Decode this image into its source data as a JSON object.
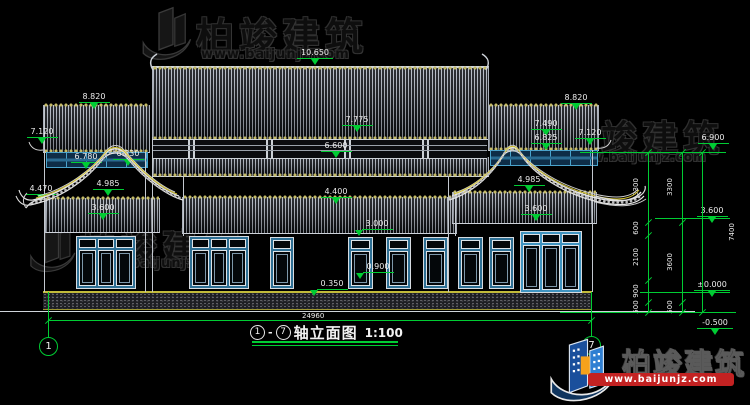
{
  "watermark": {
    "brand": "柏竣建筑",
    "url": "www.baijunjz.com"
  },
  "title_block": {
    "axis_start": "1",
    "dash": "-",
    "axis_end": "7",
    "name": "轴立面图",
    "scale": "1:100"
  },
  "bottom_dim": {
    "value": "24960",
    "x1": 48,
    "x2": 591,
    "y": 320,
    "tx": 316,
    "ty": 312
  },
  "axes": [
    {
      "label": "1",
      "cx": 48,
      "cy": 346,
      "stem_y1": 292
    },
    {
      "label": "7",
      "cx": 591,
      "cy": 345,
      "stem_y1": 292
    }
  ],
  "elevations": [
    {
      "v": "10.650",
      "x": 315,
      "y": 49
    },
    {
      "v": "8.820",
      "x": 94,
      "y": 93
    },
    {
      "v": "8.820",
      "x": 576,
      "y": 94
    },
    {
      "v": "7.775",
      "x": 357,
      "y": 116
    },
    {
      "v": "7.490",
      "x": 546,
      "y": 120
    },
    {
      "v": "7.120",
      "x": 42,
      "y": 128
    },
    {
      "v": "7.120",
      "x": 590,
      "y": 129
    },
    {
      "v": "6.825",
      "x": 546,
      "y": 134
    },
    {
      "v": "6.900",
      "x": 713,
      "y": 134
    },
    {
      "v": "6.780",
      "x": 86,
      "y": 153
    },
    {
      "v": "6.830",
      "x": 128,
      "y": 150
    },
    {
      "v": "6.600",
      "x": 336,
      "y": 142
    },
    {
      "v": "4.985",
      "x": 108,
      "y": 180
    },
    {
      "v": "4.985",
      "x": 529,
      "y": 176
    },
    {
      "v": "4.470",
      "x": 41,
      "y": 185
    },
    {
      "v": "4.400",
      "x": 336,
      "y": 188
    },
    {
      "v": "3.600",
      "x": 103,
      "y": 204
    },
    {
      "v": "3.600",
      "x": 536,
      "y": 205
    },
    {
      "v": "3.600",
      "x": 712,
      "y": 207
    },
    {
      "v": "3.000",
      "x": 377,
      "y": 220,
      "tri": "l"
    },
    {
      "v": "0.900",
      "x": 378,
      "y": 263,
      "tri": "l"
    },
    {
      "v": "0.350",
      "x": 332,
      "y": 280,
      "tri": "l"
    },
    {
      "v": "±0.000",
      "x": 712,
      "y": 281
    },
    {
      "v": "-0.500",
      "x": 715,
      "y": 319
    }
  ],
  "vchains": [
    {
      "x": 648,
      "y1": 152,
      "y2": 312,
      "ticks": [
        152,
        222,
        235,
        280,
        302,
        312
      ],
      "labels": [
        {
          "t": "3300",
          "y": 187
        },
        {
          "t": "600",
          "y": 228
        },
        {
          "t": "2100",
          "y": 257
        },
        {
          "t": "900",
          "y": 291
        },
        {
          "t": "500",
          "y": 307
        }
      ]
    },
    {
      "x": 682,
      "y1": 152,
      "y2": 312,
      "ticks": [
        152,
        222,
        302,
        312
      ],
      "labels": [
        {
          "t": "3300",
          "y": 187
        },
        {
          "t": "3600",
          "y": 262
        },
        {
          "t": "500",
          "y": 307
        }
      ]
    },
    {
      "x": 702,
      "y1": 152,
      "y2": 312,
      "ticks": [
        152,
        312
      ],
      "side": "r",
      "labels": [
        {
          "t": "7400",
          "y": 232
        }
      ]
    }
  ],
  "levels": [
    {
      "x1": 580,
      "x2": 726,
      "y": 152
    },
    {
      "x1": 655,
      "x2": 730,
      "y": 218
    },
    {
      "x1": 640,
      "x2": 730,
      "y": 292
    },
    {
      "x1": 560,
      "x2": 736,
      "y": 312
    }
  ],
  "structure": {
    "roofs": [
      {
        "name": "roof-main",
        "x": 152,
        "y": 66,
        "w": 335,
        "h": 71,
        "sc": "tb",
        "ridge": true
      },
      {
        "name": "roof-left-upper",
        "x": 43,
        "y": 105,
        "w": 105,
        "h": 47,
        "sc": "tb"
      },
      {
        "name": "roof-right-upper",
        "x": 488,
        "y": 105,
        "w": 109,
        "h": 45,
        "sc": "tb"
      },
      {
        "name": "roof-center-skirt",
        "x": 152,
        "y": 157,
        "w": 335,
        "h": 19,
        "sc": "b"
      },
      {
        "name": "roof-center-mid",
        "x": 182,
        "y": 197,
        "w": 273,
        "h": 36,
        "sc": "t"
      },
      {
        "name": "roof-left-lower",
        "x": 45,
        "y": 198,
        "w": 113,
        "h": 34,
        "sc": "t"
      },
      {
        "name": "roof-right-lower",
        "x": 452,
        "y": 192,
        "w": 143,
        "h": 31,
        "sc": "t"
      }
    ],
    "bands": [
      {
        "kind": "fascia",
        "name": "bracket-band-center",
        "x": 152,
        "y": 139,
        "w": 335,
        "h": 18
      },
      {
        "kind": "blueband",
        "name": "window-band-left",
        "x": 46,
        "y": 152,
        "w": 100,
        "h": 14
      },
      {
        "kind": "blueband",
        "name": "window-band-right",
        "x": 490,
        "y": 150,
        "w": 106,
        "h": 14
      }
    ],
    "columns": [
      {
        "x": 44,
        "y1": 107,
        "y2": 292
      },
      {
        "x": 145,
        "y1": 152,
        "y2": 292
      },
      {
        "x": 152,
        "y1": 137,
        "y2": 292
      },
      {
        "x": 183,
        "y1": 176,
        "y2": 236
      },
      {
        "x": 448,
        "y1": 176,
        "y2": 292
      },
      {
        "x": 455,
        "y1": 192,
        "y2": 236
      },
      {
        "x": 592,
        "y1": 150,
        "y2": 292
      }
    ]
  },
  "windows": [
    {
      "type": "wide",
      "x": 76,
      "y": 236,
      "w": 54,
      "h": 47
    },
    {
      "type": "wide",
      "x": 189,
      "y": 236,
      "w": 54,
      "h": 47
    },
    {
      "type": "narrow",
      "x": 270,
      "y": 237,
      "w": 18,
      "h": 46
    },
    {
      "type": "narrow",
      "x": 348,
      "y": 237,
      "w": 19,
      "h": 46
    },
    {
      "type": "narrow",
      "x": 386,
      "y": 237,
      "w": 19,
      "h": 46
    },
    {
      "type": "narrow",
      "x": 423,
      "y": 237,
      "w": 19,
      "h": 46
    },
    {
      "type": "narrow",
      "x": 458,
      "y": 237,
      "w": 19,
      "h": 46
    },
    {
      "type": "narrow",
      "x": 489,
      "y": 237,
      "w": 19,
      "h": 46
    },
    {
      "type": "door",
      "x": 520,
      "y": 231,
      "w": 56,
      "h": 56
    }
  ]
}
